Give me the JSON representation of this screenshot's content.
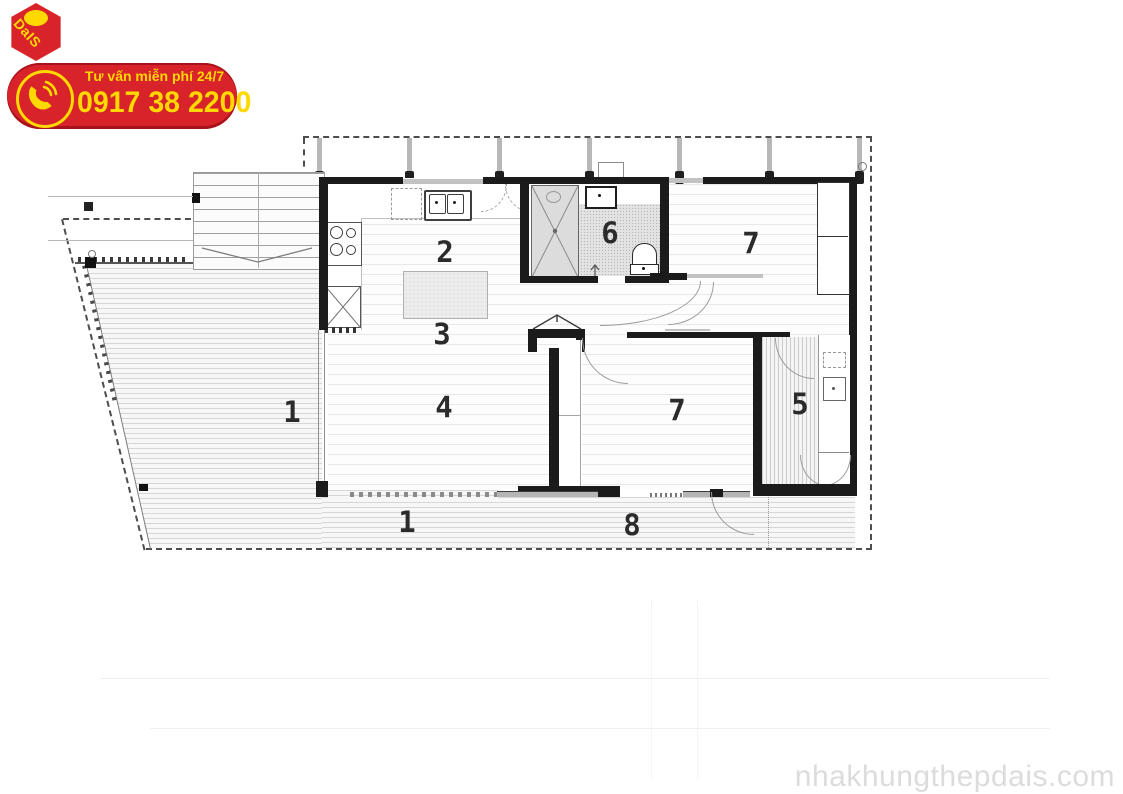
{
  "branding": {
    "logo_text": "DaIS",
    "hotline_label": "Tư vấn miễn phí 24/7",
    "hotline_number": "0917 38 2200",
    "brand_red": "#d8232a",
    "brand_red_dark": "#a8121a",
    "brand_yellow": "#ffd800"
  },
  "watermark": {
    "text": "nhakhungthepdais.com",
    "color": "#dcdcdc"
  },
  "floor_plan": {
    "wall_color": "#1b1b1b",
    "label_color": "#2b2b2b",
    "room_labels": [
      {
        "id": "deck-left",
        "label": "1",
        "x": 292,
        "y": 412
      },
      {
        "id": "kitchen",
        "label": "2",
        "x": 445,
        "y": 252
      },
      {
        "id": "island",
        "label": "3",
        "x": 442,
        "y": 334
      },
      {
        "id": "living",
        "label": "4",
        "x": 444,
        "y": 407
      },
      {
        "id": "utility",
        "label": "5",
        "x": 800,
        "y": 404
      },
      {
        "id": "bathroom",
        "label": "6",
        "x": 610,
        "y": 233
      },
      {
        "id": "bedroom-1",
        "label": "7",
        "x": 751,
        "y": 243
      },
      {
        "id": "bedroom-2",
        "label": "7",
        "x": 677,
        "y": 410
      },
      {
        "id": "deck-bottom",
        "label": "1",
        "x": 407,
        "y": 522
      },
      {
        "id": "porch",
        "label": "8",
        "x": 632,
        "y": 525
      }
    ],
    "posts_x": [
      319,
      409,
      499,
      589,
      679,
      769,
      859
    ]
  }
}
